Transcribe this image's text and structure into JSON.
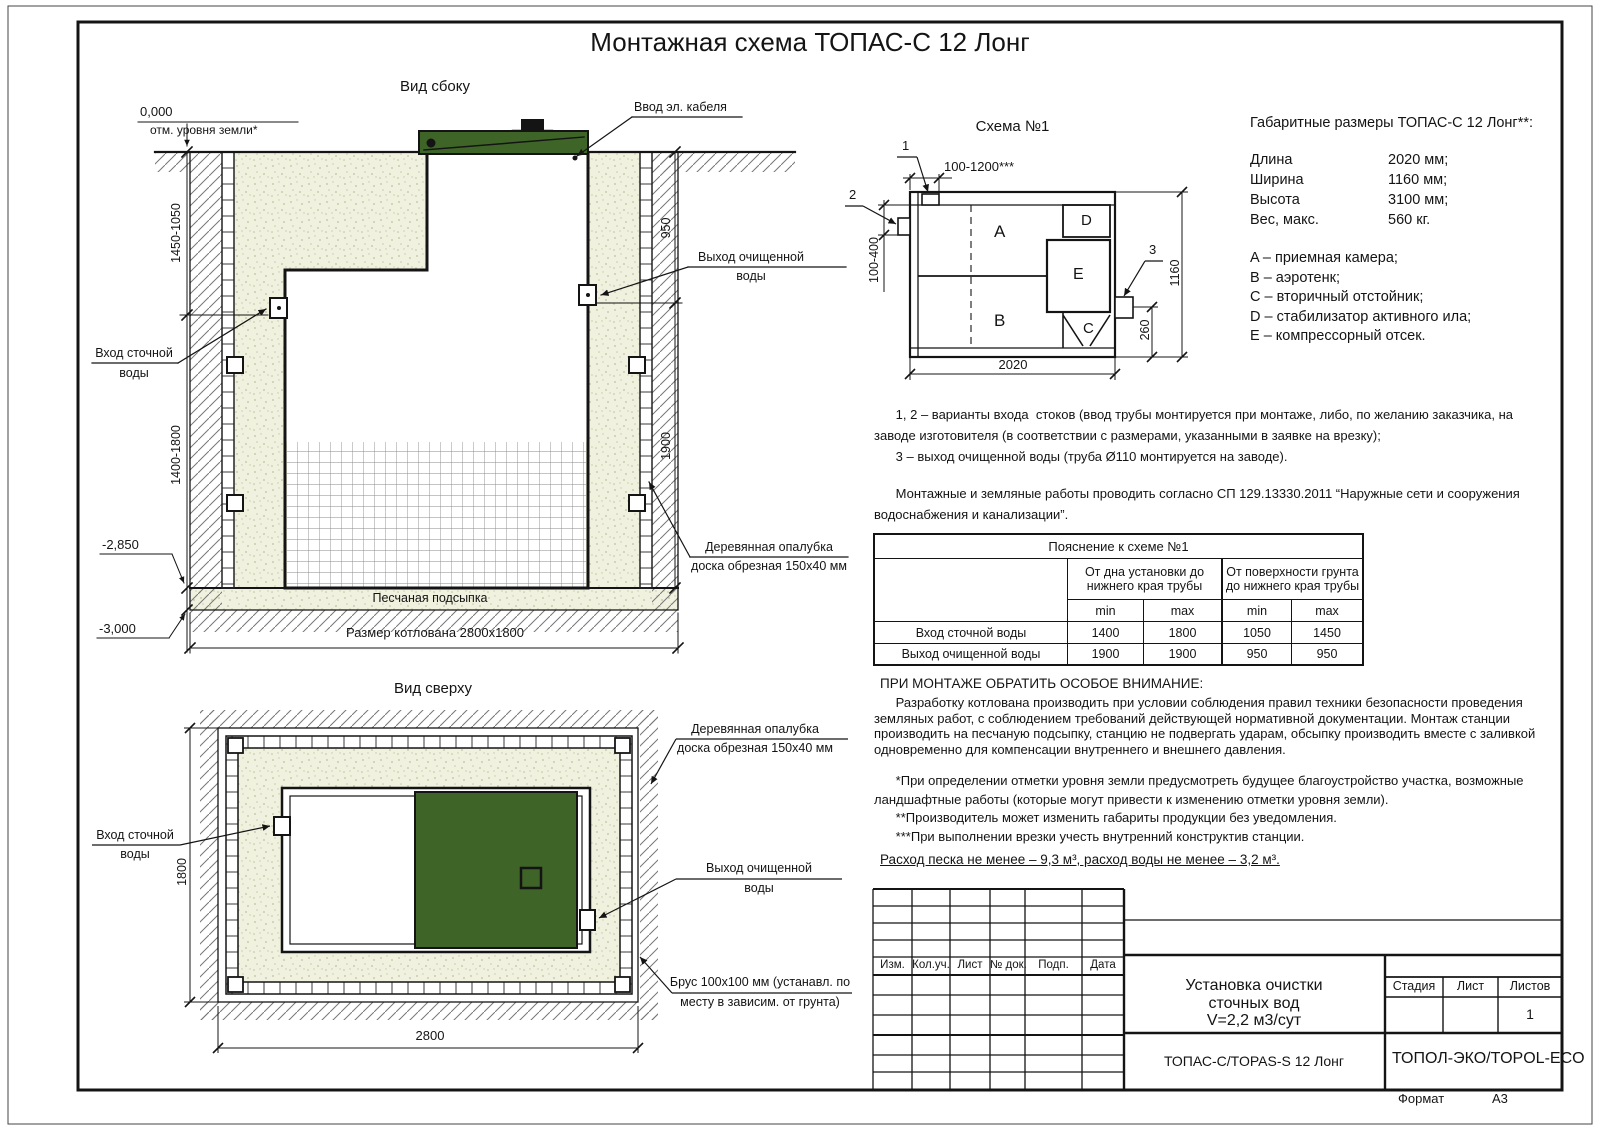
{
  "page": {
    "title": "Монтажная схема ТОПАС-С 12 Лонг",
    "format_label": "Формат",
    "format_value": "А3"
  },
  "colors": {
    "lid_green": "#3e6527",
    "sand_beige": "#f0f1de",
    "line_black": "#141414"
  },
  "side_view": {
    "title": "Вид сбоку",
    "zero_mark": "0,000",
    "ground_note": "отм. уровня земли*",
    "dim_left_upper": "1450-1050",
    "dim_left_lower": "1400-1800",
    "dim_right_upper": "950",
    "dim_right_lower": "1900",
    "mark_2850": "-2,850",
    "mark_3000": "-3,000",
    "cable_label": "Ввод эл. кабеля",
    "inlet_label_1": "Вход сточной",
    "inlet_label_2": "воды",
    "outlet_label_1": "Выход очищенной",
    "outlet_label_2": "воды",
    "formwork_label_1": "Деревянная опалубка",
    "formwork_label_2": "доска обрезная 150х40 мм",
    "sand_label": "Песчаная подсыпка",
    "pit_size_label": "Размер котлована 2800х1800"
  },
  "top_view": {
    "title": "Вид сверху",
    "dim_width": "1800",
    "dim_length": "2800",
    "inlet_label_1": "Вход сточной",
    "inlet_label_2": "воды",
    "outlet_label_1": "Выход очищенной",
    "outlet_label_2": "воды",
    "formwork_label_1": "Деревянная опалубка",
    "formwork_label_2": "доска обрезная 150х40 мм",
    "timber_label_1": "Брус 100х100 мм (устанавл. по",
    "timber_label_2": "месту в зависим. от грунта)"
  },
  "schema": {
    "title": "Схема №1",
    "comp_a": "A",
    "comp_b": "B",
    "comp_c": "C",
    "comp_d": "D",
    "comp_e": "E",
    "pipe_1": "1",
    "pipe_2": "2",
    "pipe_3": "3",
    "dim_top": "100-1200***",
    "dim_left": "100-400",
    "dim_right": "1160",
    "dim_outlet": "260",
    "dim_bottom": "2020"
  },
  "specs": {
    "heading": "Габаритные размеры ТОПАС-С 12 Лонг**:",
    "rows": [
      {
        "label": "Длина",
        "value": "2020 мм;"
      },
      {
        "label": "Ширина",
        "value": "1160 мм;"
      },
      {
        "label": "Высота",
        "value": "3100 мм;"
      },
      {
        "label": "Вес, макс.",
        "value": "560 кг."
      }
    ],
    "legend": [
      "A – приемная камера;",
      "B – аэротенк;",
      "C – вторичный отстойник;",
      "D – стабилизатор активного ила;",
      "E – компрессорный отсек."
    ]
  },
  "notes": {
    "pipes_note": "      1, 2 – варианты входа  стоков (ввод трубы монтируется при монтаже, либо, по желанию заказчика, на\nзаводе изготовителя (в соответствии с размерами, указанными в заявке на врезку);\n      3 – выход очищенной воды (труба Ø110 монтируется на заводе).",
    "sp_note": "      Монтажные и земляные работы проводить согласно СП 129.13330.2011 “Наружные сети и сооружения\nводоснабжения и канализации”.",
    "attention_heading": "ПРИ МОНТАЖЕ ОБРАТИТЬ ОСОБОЕ ВНИМАНИЕ:",
    "attention_body": "      Разработку котлована производить при условии соблюдения правил техники безопасности проведения\nземляных работ, с соблюдением требований действующей нормативной документации. Монтаж станции\nпроизводить на песчаную подсыпку, станцию не подвергать ударам, обсыпку производить вместе с заливкой\nодновременно для компенсации внутреннего и внешнего давления.",
    "asterisk_notes": "      *При определении отметки уровня земли предусмотреть будущее благоустройство участка, возможные\nландшафтные работы (которые могут привести к изменению отметки уровня земли).\n      **Производитель может изменить габариты продукции без уведомления.\n      ***При выполнении врезки учесть внутренний конструктив станции.",
    "consumption": "Расход песка не менее – 9,3 м³, расход воды не менее – 3,2 м³."
  },
  "explain_table": {
    "title": "Пояснение к схеме №1",
    "col_group1": "От дна установки до\nнижнего края трубы",
    "col_group2": "От поверхности грунта\nдо нижнего края трубы",
    "min1": "min",
    "max1": "max",
    "min2": "min",
    "max2": "max",
    "rows": [
      {
        "label": "Вход сточной воды",
        "v1": "1400",
        "v2": "1800",
        "v3": "1050",
        "v4": "1450"
      },
      {
        "label": "Выход очищенной воды",
        "v1": "1900",
        "v2": "1900",
        "v3": "950",
        "v4": "950"
      }
    ]
  },
  "title_block": {
    "rev_headers": [
      "Изм.",
      "Кол.уч.",
      "Лист",
      "№ док.",
      "Подп.",
      "Дата"
    ],
    "doc_title": "Установка очистки\nсточных вод\nV=2,2 м3/сут",
    "stage_label": "Стадия",
    "sheet_label": "Лист",
    "sheets_label": "Листов",
    "sheets_value": "1",
    "model_label": "ТОПАС-С/TOPAS-S 12 Лонг",
    "company_label": "ТОПОЛ-ЭКО/TOPOL-ECO"
  }
}
